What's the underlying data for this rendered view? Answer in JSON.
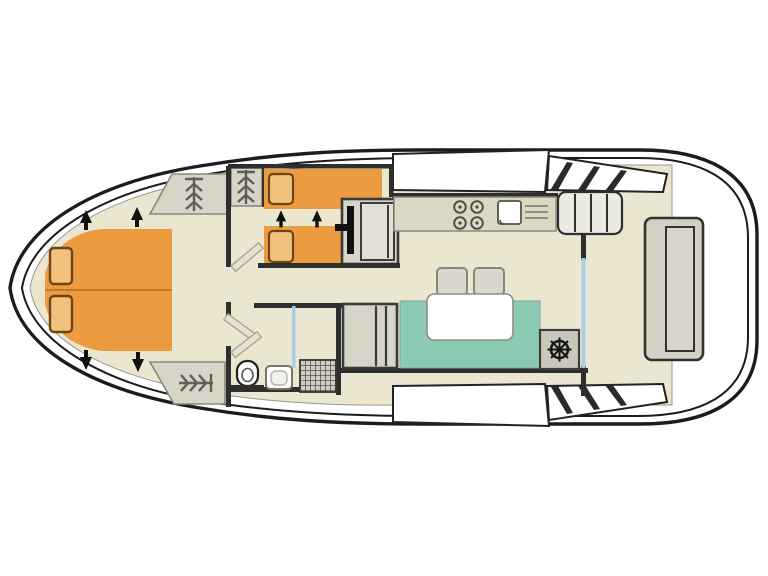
{
  "diagram": {
    "kind": "boat-deck-floorplan",
    "orientation": "bow-left-stern-right"
  },
  "colors": {
    "floor": "#eae6cf",
    "bed_orange": "#ec9b40",
    "bed_line": "#c07a28",
    "pillow": "#f2c17d",
    "pillow_border": "#6d4413",
    "sofa_teal": "#8ccab3",
    "furniture": "#d7d5c8",
    "furniture_dark": "#c9c7ba",
    "wall": "#2e2e2e",
    "hull": "#1c1c1c",
    "white": "#ffffff",
    "glass": "#a9cdea",
    "counter": "#dbd8c4",
    "icon": "#5f5f58",
    "outline": "#8a887a"
  },
  "icons": {
    "wardrobe-hanger-icon": "stack of coat hangers",
    "ship-wheel-icon": "helm steering wheel",
    "stove-burner-icon": "burner ring",
    "direction-arrow-icon": "solid black arrow",
    "toilet-icon": "toilet top view",
    "sink-icon": "basin with drainboard",
    "shower-icon": "drain grid square",
    "door-leaf-icon": "open door leaf",
    "deck-step-stripe-icon": "diagonal step stripe"
  },
  "fixtures": [
    "bow-double-bed",
    "bow-bed-pillows",
    "wardrobe-forward-port",
    "wardrobe-mid",
    "wardrobe-aft-port",
    "twin-cabin-upper-bed",
    "twin-cabin-lower-bed",
    "cabin-desk-seat-unit",
    "companionway-steps",
    "bathroom-toilet",
    "bathroom-sink",
    "shower-tray",
    "shower-partition",
    "galley-counter",
    "galley-stove",
    "galley-sink",
    "storage-cabinet",
    "dinette-sofa",
    "dinette-table",
    "dinette-stools",
    "helm-console",
    "helm-wheel",
    "sliding-glass-door",
    "side-deck-steps",
    "aft-bench"
  ]
}
